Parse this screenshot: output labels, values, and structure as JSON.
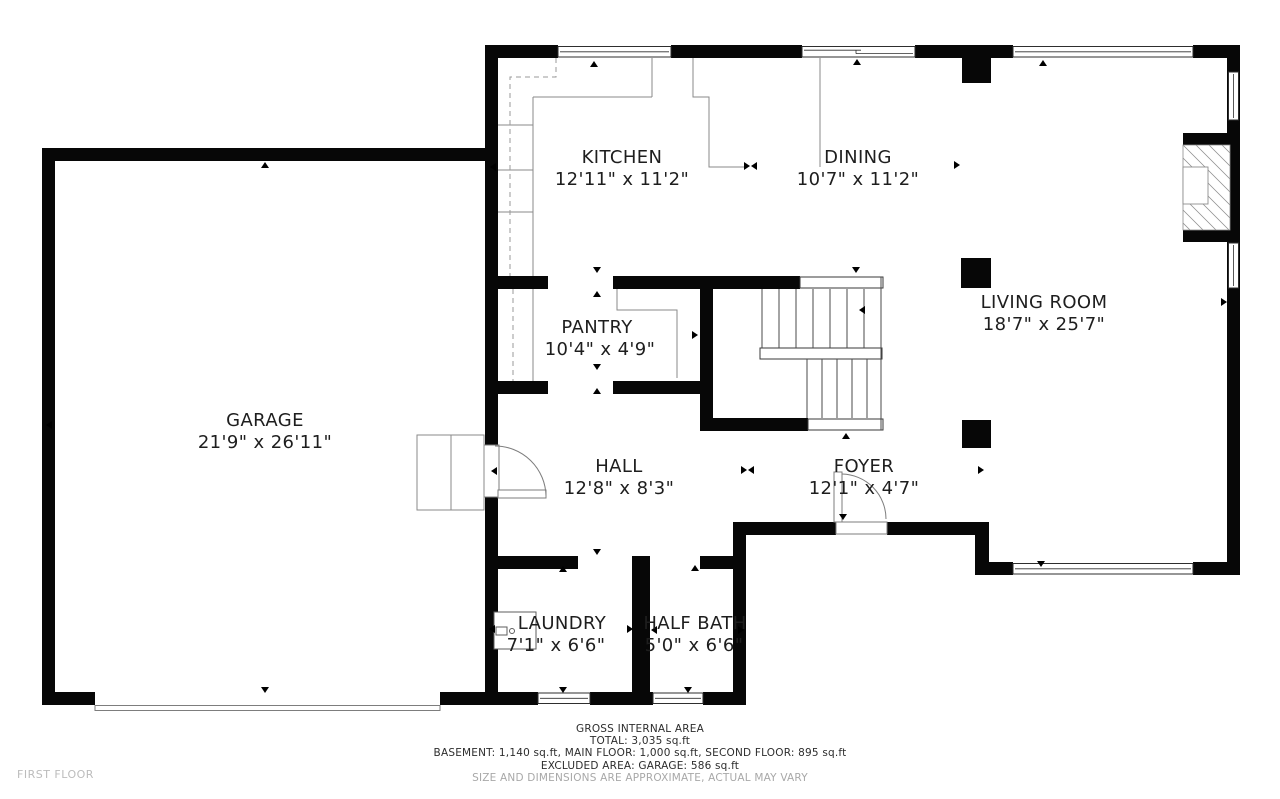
{
  "floor_label": "FIRST FLOOR",
  "rooms": [
    {
      "name": "KITCHEN",
      "dims": "12'11\" x 11'2\""
    },
    {
      "name": "DINING",
      "dims": "10'7\" x 11'2\""
    },
    {
      "name": "LIVING ROOM",
      "dims": "18'7\" x 25'7\""
    },
    {
      "name": "PANTRY",
      "dims": "10'4\" x 4'9\""
    },
    {
      "name": "GARAGE",
      "dims": "21'9\" x 26'11\""
    },
    {
      "name": "HALL",
      "dims": "12'8\" x 8'3\""
    },
    {
      "name": "FOYER",
      "dims": "12'1\" x 4'7\""
    },
    {
      "name": "LAUNDRY",
      "dims": "7'1\" x 6'6\""
    },
    {
      "name": "HALF BATH",
      "dims": "5'0\" x 6'6\""
    }
  ],
  "footer": {
    "line1": "GROSS INTERNAL AREA",
    "line2": "TOTAL: 3,035 sq.ft",
    "line3": "BASEMENT: 1,140 sq.ft, MAIN FLOOR: 1,000 sq.ft, SECOND FLOOR: 895 sq.ft",
    "line4": "EXCLUDED AREA: GARAGE: 586 sq.ft",
    "disclaimer": "SIZE AND DIMENSIONS ARE APPROXIMATE, ACTUAL MAY VARY"
  },
  "icons": {
    "door_swing": "quarter-arc",
    "dimension_arrow": "small-triangle",
    "washer": "box-with-dial",
    "fireplace": "hatched-box",
    "stairs": "parallel-treads"
  },
  "colors": {
    "wall": "#070707",
    "thin_line": "#8a8a8a",
    "label_text": "#1e1e1e",
    "disclaimer_text": "#a8a8a8"
  }
}
